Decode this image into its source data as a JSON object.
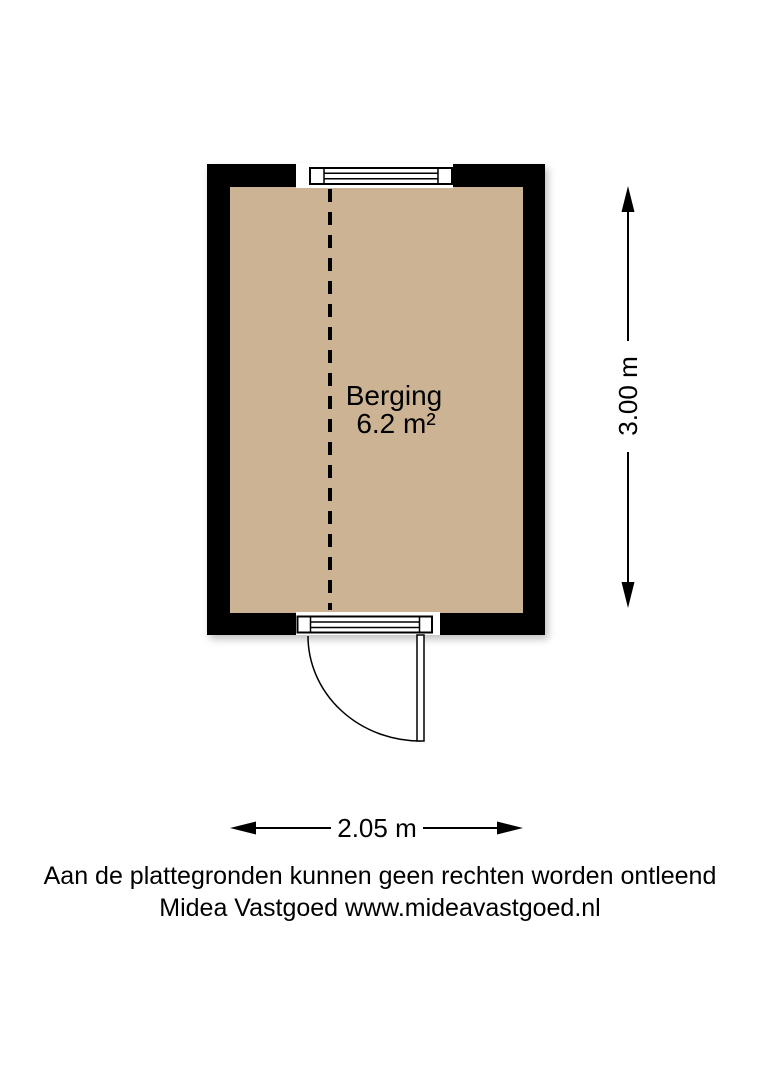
{
  "room": {
    "name": "Berging",
    "area": "6.2 m²"
  },
  "dimensions": {
    "vertical": "3.00 m",
    "horizontal": "2.05 m"
  },
  "footer": {
    "disclaimer": "Aan de plattegronden kunnen geen rechten worden ontleend",
    "credit": "Midea Vastgoed www.mideavastgoed.nl"
  },
  "colors": {
    "wall": "#000000",
    "floor": "#cbb393",
    "ink": "#000000",
    "background": "#ffffff"
  }
}
